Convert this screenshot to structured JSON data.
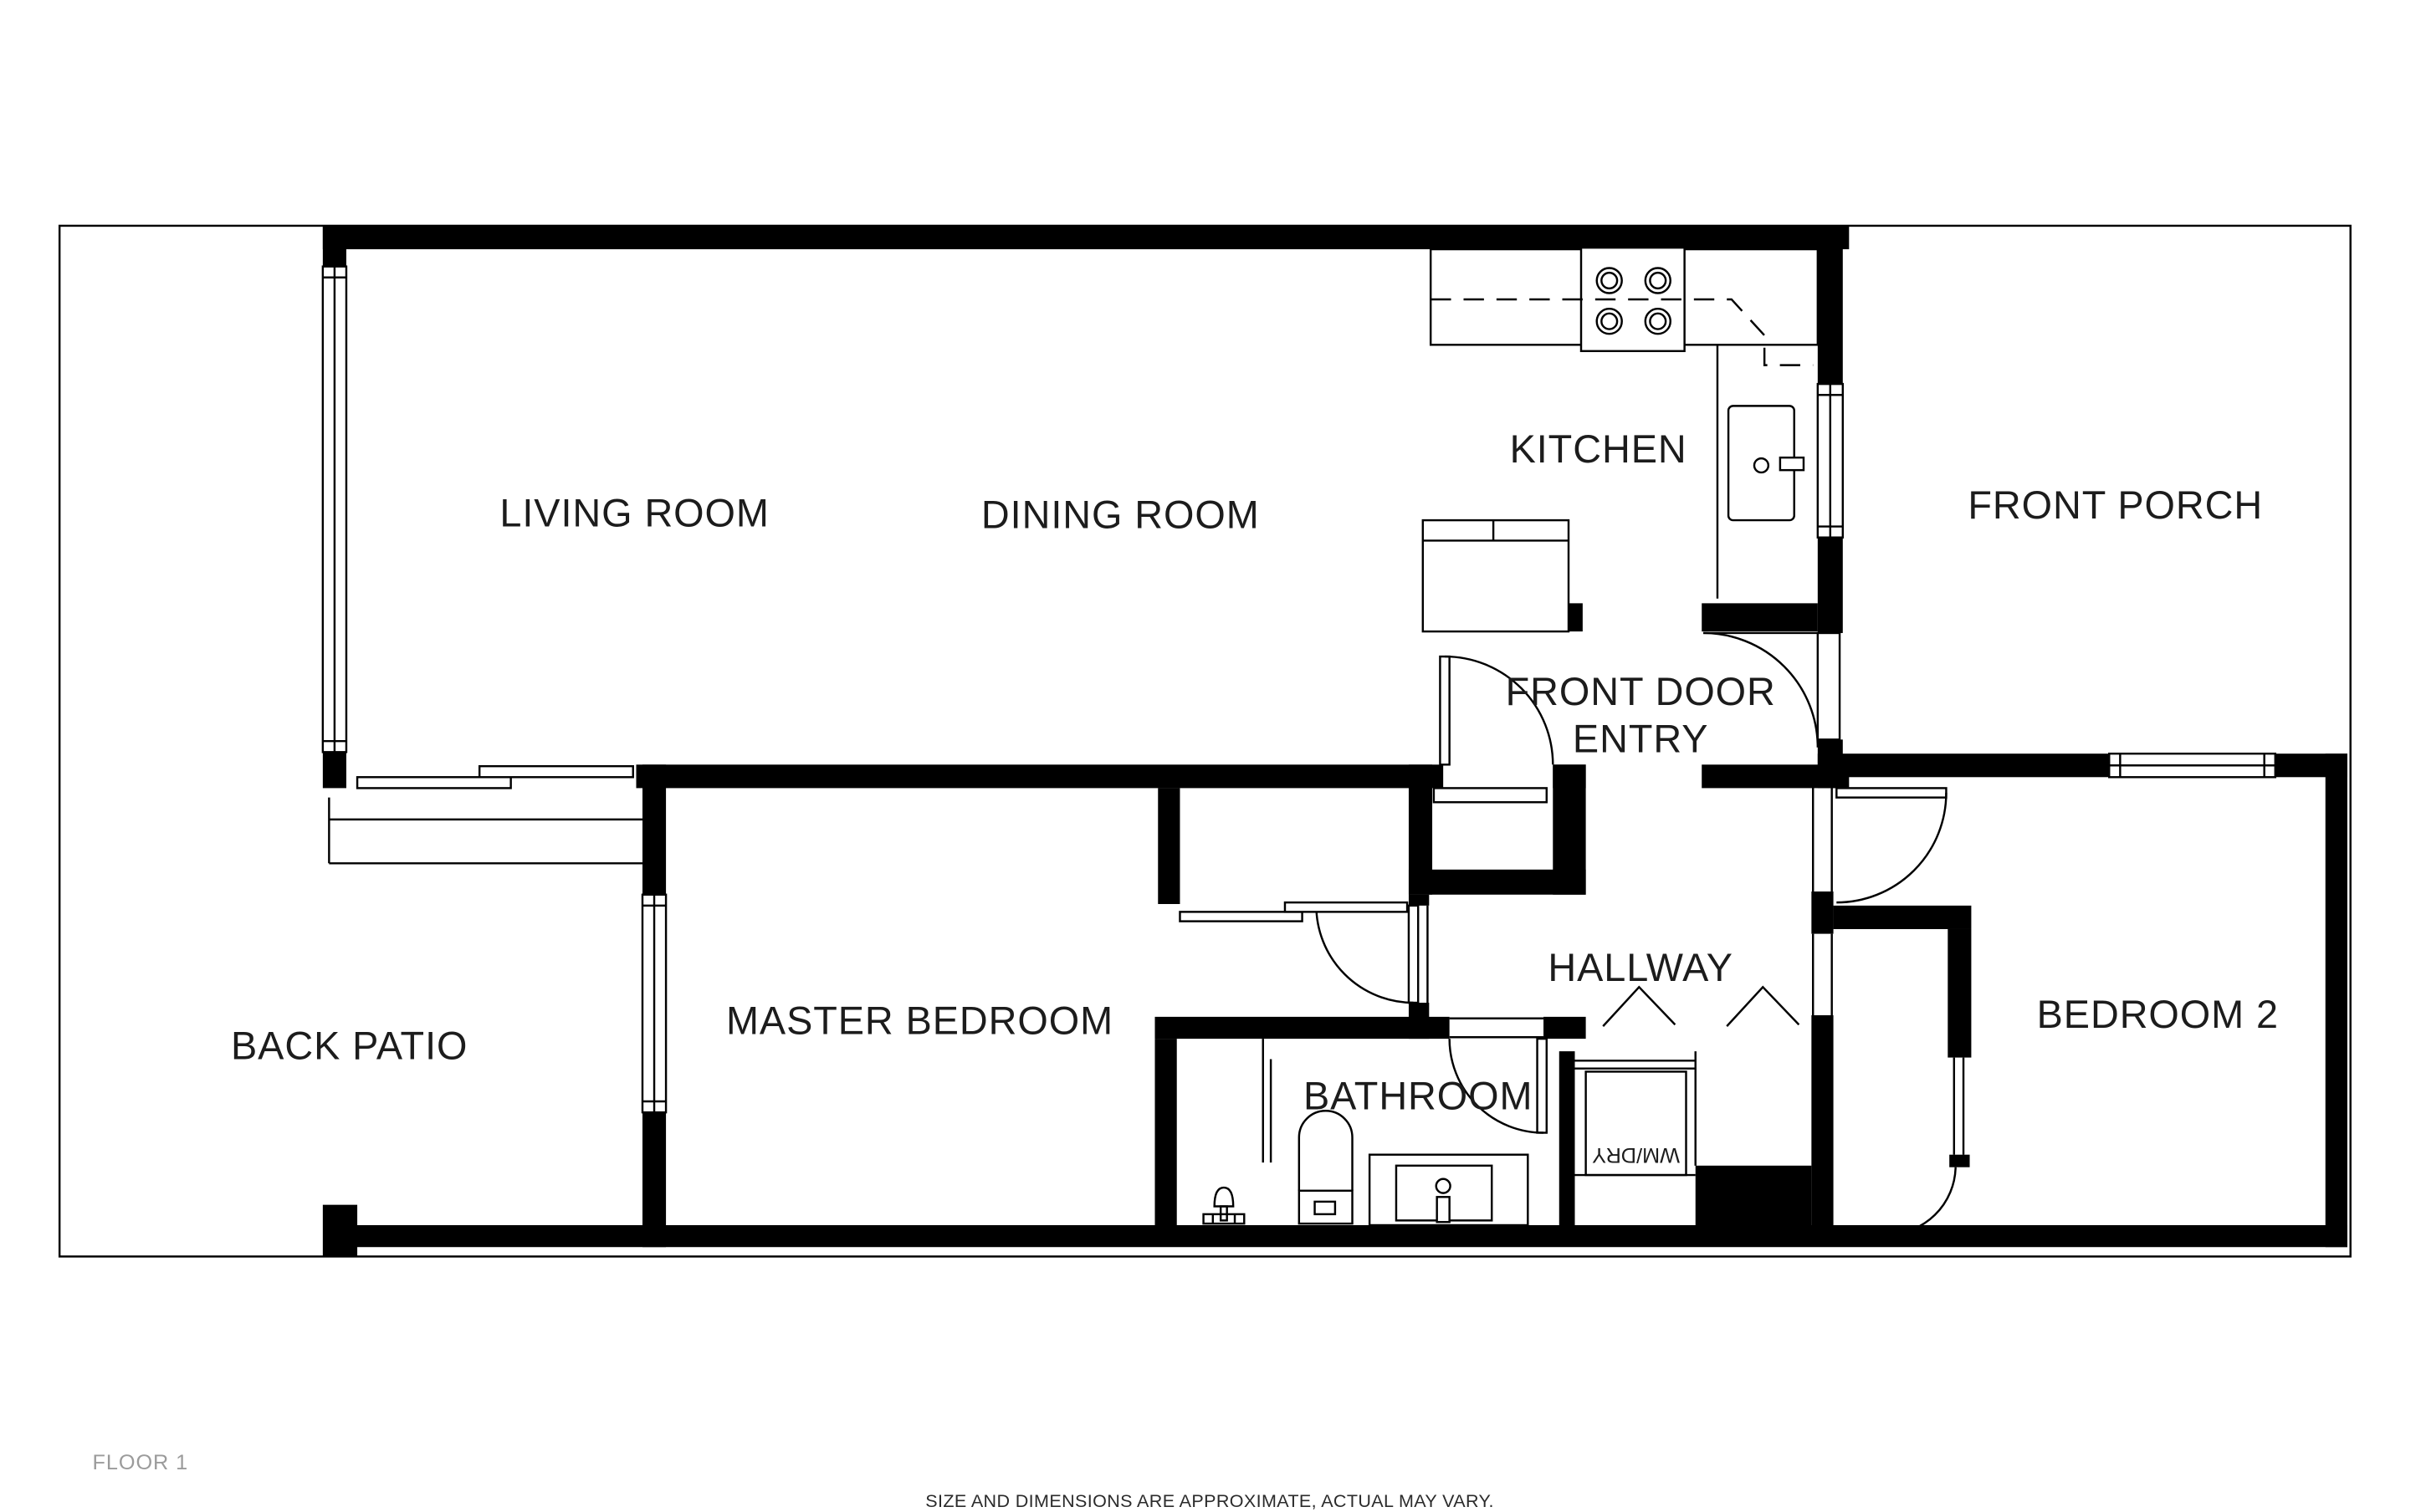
{
  "page": {
    "background": "#ffffff",
    "line_color": "#000000",
    "muted_text_color": "#9b9b9b",
    "disclaimer_text_color": "#2b2b2b"
  },
  "labels": {
    "living_room": "LIVING ROOM",
    "dining_room": "DINING ROOM",
    "kitchen": "KITCHEN",
    "front_porch": "FRONT PORCH",
    "front_door_line1": "FRONT DOOR",
    "front_door_line2": "ENTRY",
    "hallway": "HALLWAY",
    "master_bedroom": "MASTER BEDROOM",
    "bathroom": "BATHROOM",
    "bedroom_2": "BEDROOM 2",
    "back_patio": "BACK PATIO",
    "wm_dry": "WM/DRY"
  },
  "footer": {
    "floor_label": "FLOOR 1",
    "disclaimer": "SIZE AND DIMENSIONS ARE APPROXIMATE, ACTUAL MAY VARY."
  }
}
